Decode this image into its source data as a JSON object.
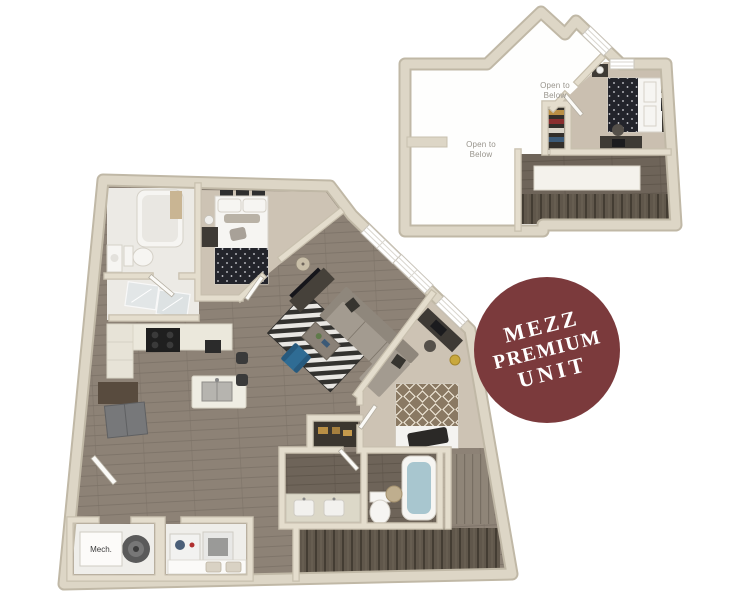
{
  "badge": {
    "line1": "MEZZ",
    "line2": "PREMIUM",
    "line3": "UNIT"
  },
  "mezzanine_plan": {
    "label_open_left": {
      "line1": "Open to",
      "line2": "Below"
    },
    "label_open_right": {
      "line1": "Open to",
      "line2": "Below"
    }
  },
  "main_plan": {
    "label_mech": "Mech."
  },
  "palette": {
    "badge_bg": "#7b3a3c",
    "badge_text": "#ffffff",
    "wall": "#ddd6c6",
    "wall_edge": "#c0b8a6",
    "wall_int": "#e4ddcd",
    "wall_int_edge": "#c8c0ae",
    "wood": "#8d8276",
    "wood_dark": "#6e6459",
    "carpet": "#cdc3b4",
    "carpet_mezz": "#cabfb0",
    "bath_floor": "#eceae5",
    "water": "#a8c6cf",
    "chair_blue": "#2f6c94",
    "bed_dark": "#23242b",
    "bed_tan": "#8a7963",
    "sofa": "#a39b90",
    "sofa_dark": "#8f877c",
    "stair": "#60574b",
    "stair_dark": "#443d33",
    "label": "#98948c"
  }
}
